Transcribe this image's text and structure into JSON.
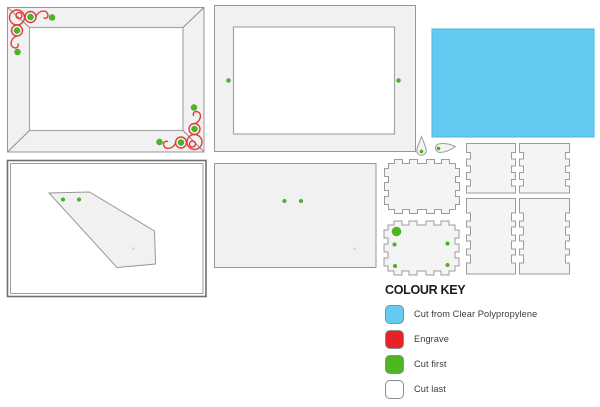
{
  "colour_key": {
    "title": "COLOUR KEY",
    "items": [
      {
        "label": "Cut from Clear Polypropylene",
        "color": "#63cbf1"
      },
      {
        "label": "Engrave",
        "color": "#e62227"
      },
      {
        "label": "Cut first",
        "color": "#4fb521"
      },
      {
        "label": "Cut last",
        "color": "#ffffff"
      }
    ]
  },
  "colors": {
    "polypropylene": "#63cbf1",
    "engrave_line": "#e23b3e",
    "cut_first_dot": "#4fb521",
    "part_fill": "#f1f1f1",
    "outline": "#979797"
  }
}
